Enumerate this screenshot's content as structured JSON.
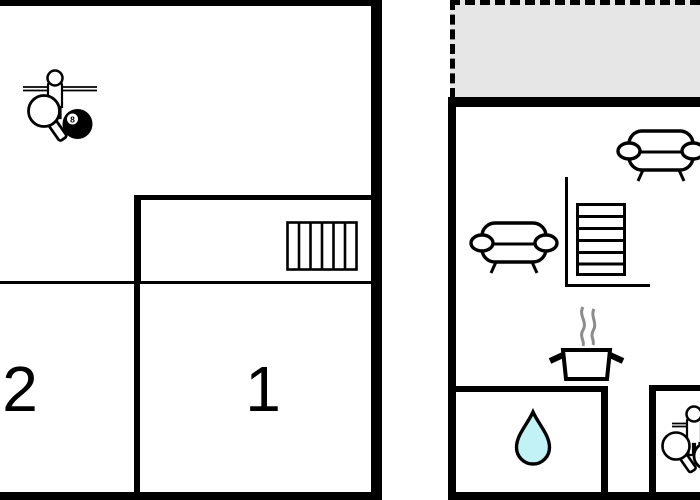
{
  "colors": {
    "wall": "#000000",
    "paper": "#ffffff",
    "terrace": "#e6e6e6",
    "drop": "#c2f2f5",
    "steam": "#8c8c8c"
  },
  "labels": {
    "room1": "1",
    "room2": "2",
    "eight_ball": "8"
  },
  "icons": {
    "left_building": [
      "foosball-player-icon",
      "table-tennis-paddle-icon",
      "eight-ball-icon",
      "radiator-icon"
    ],
    "right_building": [
      "terrace-area",
      "sofa-icon",
      "sofa-icon",
      "stairs-icon",
      "steam-icon",
      "cooking-pot-icon",
      "water-drop-icon",
      "foosball-player-icon",
      "table-tennis-paddle-icon",
      "ball-icon"
    ]
  }
}
